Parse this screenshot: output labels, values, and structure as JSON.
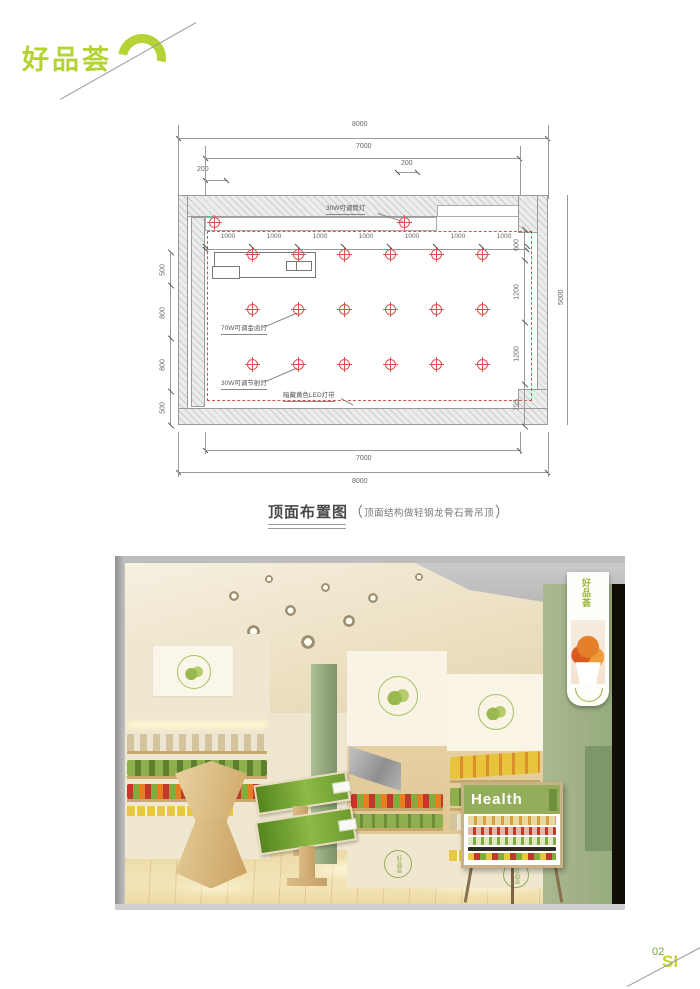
{
  "logo": {
    "text": "好品荟"
  },
  "plan": {
    "dim_top_outer": "8000",
    "dim_top_inner": "7000",
    "dim_offset_left": "200",
    "dim_offset_mid": "200",
    "dim_spacings": [
      "1000",
      "1000",
      "1000",
      "1000",
      "1000",
      "1000",
      "1000"
    ],
    "dims_left": [
      "500",
      "800",
      "800",
      "500"
    ],
    "dims_right": [
      "600",
      "1200",
      "1200",
      "795"
    ],
    "dim_right_outer": "5000",
    "dim_bottom_inner": "7000",
    "dim_bottom_outer": "8000",
    "label_downlight": "30W可调筒灯",
    "label_metal_halide": "70W可调金卤灯",
    "label_spotlight": "30W可调节射灯",
    "label_led_strip": "暗藏黄色LED灯带",
    "colors": {
      "light_symbol": "#d9534f"
    }
  },
  "caption": {
    "title": "顶面布置图",
    "open": "（",
    "note": "顶面结构做轻钢龙骨石膏吊顶",
    "close": "）"
  },
  "render": {
    "lightbox_logo": "好品荟",
    "cabinet_logo_left": "好品荟",
    "cabinet_logo_right": "好品荟",
    "poster_title": "Health"
  },
  "footer": {
    "page_number": "02",
    "mark": "SI"
  },
  "colors": {
    "accent_green": "#b5d334",
    "footer_green": "#76a23e",
    "drawing_red": "#d9534f",
    "sage": "#a3b68b",
    "wood": "#dcbc84",
    "floor": "#eedcab",
    "dark_edge": "#15100c",
    "poster_green": "#93ad5a"
  }
}
